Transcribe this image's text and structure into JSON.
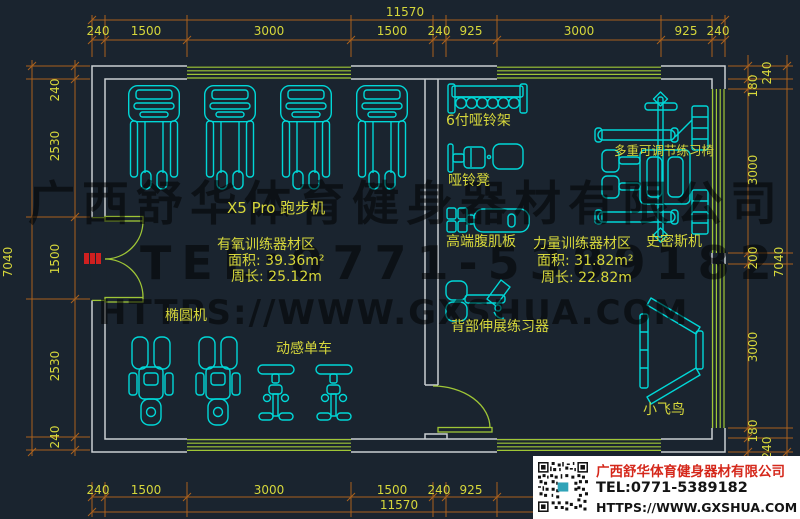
{
  "plan": {
    "dims": {
      "top_total": "11570",
      "top": [
        "240",
        "1500",
        "3000",
        "1500",
        "240",
        "925",
        "3000",
        "925",
        "240"
      ],
      "bottom": [
        "240",
        "1500",
        "3000",
        "1500",
        "240",
        "925",
        "3000",
        "925",
        "240"
      ],
      "bottom_total": "11570",
      "left": [
        "240",
        "2530",
        "1500",
        "2530",
        "240"
      ],
      "left_total": "7040",
      "right": [
        "240",
        "180",
        "3000",
        "200",
        "3000",
        "180",
        "240"
      ],
      "right_total": "7040"
    },
    "equipment_labels": {
      "treadmill": "X5 Pro 跑步机",
      "dumbbell_rack": "6付哑铃架",
      "dumbbell_bench": "哑铃凳",
      "ab_board": "高端腹肌板",
      "adjustable_chair": "多重可调节练习椅",
      "smith_machine": "史密斯机",
      "back_extension": "背部伸展练习器",
      "elliptical": "椭圆机",
      "spin_bike": "动感单车",
      "cable_fly": "小飞鸟"
    },
    "zones": {
      "cardio": {
        "name": "有氧训练器材区",
        "area": "面积: 39.36m²",
        "perimeter": "周长: 25.12m"
      },
      "strength": {
        "name": "力量训练器材区",
        "area": "面积: 31.82m²",
        "perimeter": "周长: 22.82m"
      }
    }
  },
  "watermark": {
    "line1": "广西舒华体育健身器材有限公司",
    "line2": "TEL:0771-5389182",
    "line3": "HTTPS://WWW.GXSHUA.COM"
  },
  "info_panel": {
    "company": "广西舒华体育健身器材有限公司",
    "tel": "TEL:0771-5389182",
    "website": "HTTPS://WWW.GXSHUA.COM"
  },
  "colors": {
    "background": "#1a242f",
    "equipment": "#00d7d7",
    "dimension_line": "#aa611d",
    "dimension_text": "#d6d73b",
    "wall": "#c9ced2",
    "window_door": "#9fc636",
    "door_marker": "#cf2020",
    "watermark": "rgba(0,0,0,0.52)",
    "panel_accent": "#d5281b"
  }
}
